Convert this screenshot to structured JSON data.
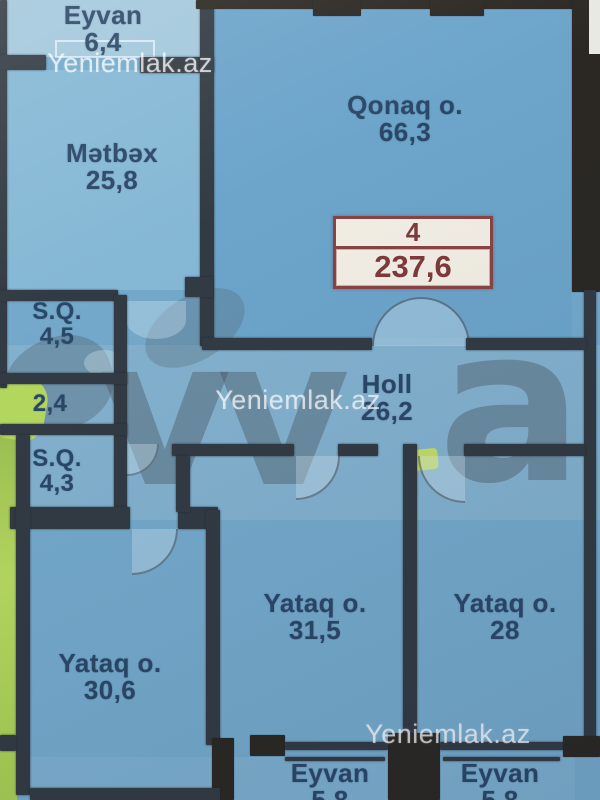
{
  "watermark": {
    "site_text": "Yeniemlak.az",
    "logo_text_vv": "vv",
    "logo_text_a": "a"
  },
  "badge": {
    "value_top": "4",
    "value_bottom": "237,6"
  },
  "rooms": [
    {
      "key": "eyvan-top",
      "name": "Eyvan",
      "area": "6,4"
    },
    {
      "key": "metbex",
      "name": "Mətbəx",
      "area": "25,8"
    },
    {
      "key": "qonaq",
      "name": "Qonaq o.",
      "area": "66,3"
    },
    {
      "key": "sq-upper",
      "name": "S.Q.",
      "area": "4,5"
    },
    {
      "key": "corridor",
      "name": "",
      "area": "2,4"
    },
    {
      "key": "sq-lower",
      "name": "S.Q.",
      "area": "4,3"
    },
    {
      "key": "holl",
      "name": "Holl",
      "area": "26,2"
    },
    {
      "key": "yataq-left",
      "name": "Yataq o.",
      "area": "30,6"
    },
    {
      "key": "yataq-middle",
      "name": "Yataq o.",
      "area": "31,5"
    },
    {
      "key": "yataq-right",
      "name": "Yataq o.",
      "area": "28"
    },
    {
      "key": "eyvan-bottom-left",
      "name": "Eyvan",
      "area": "5,8"
    },
    {
      "key": "eyvan-bottom-right",
      "name": "Eyvan",
      "area": "5,8"
    }
  ],
  "colors": {
    "bg": "#74a9cb",
    "qonaq": "#6ca4ca",
    "kitchen": "#85b8d5",
    "eyvan_top": "#a3c8dc",
    "wall": "#323a43",
    "wall_dark": "#2b2823",
    "label": "#2b4767",
    "badge_border": "#8a4343",
    "badge_bg": "#f2eee4",
    "badge_text": "#7e3a3a",
    "wm_white": "rgba(255,255,255,0.72)",
    "wm_gray": "rgba(70,82,92,0.40)",
    "green": "#aed45a",
    "sliver": "#e9e9e3"
  }
}
